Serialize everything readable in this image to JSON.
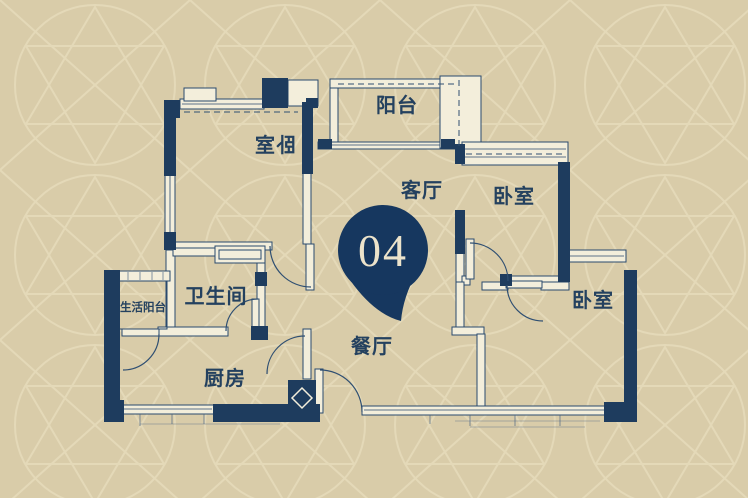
{
  "unit_marker": {
    "number": "04"
  },
  "rooms": {
    "bedroom_1": {
      "label": "卧室",
      "mirrored": true
    },
    "balcony": {
      "label": "阳台"
    },
    "living_room": {
      "label": "客厅"
    },
    "bedroom_2": {
      "label": "卧室"
    },
    "bedroom_3": {
      "label": "卧室"
    },
    "service_balcony": {
      "label": "生活阳台"
    },
    "bathroom": {
      "label": "卫生间"
    },
    "kitchen": {
      "label": "厨房"
    },
    "dining_room": {
      "label": "餐厅"
    }
  },
  "colors": {
    "background": "#d9cca9",
    "pattern_line": "#e7dcbc",
    "wall": "#1e3c5e",
    "label_text": "#24415f",
    "marker_fill": "#16375f",
    "marker_text": "#ece3cb"
  }
}
